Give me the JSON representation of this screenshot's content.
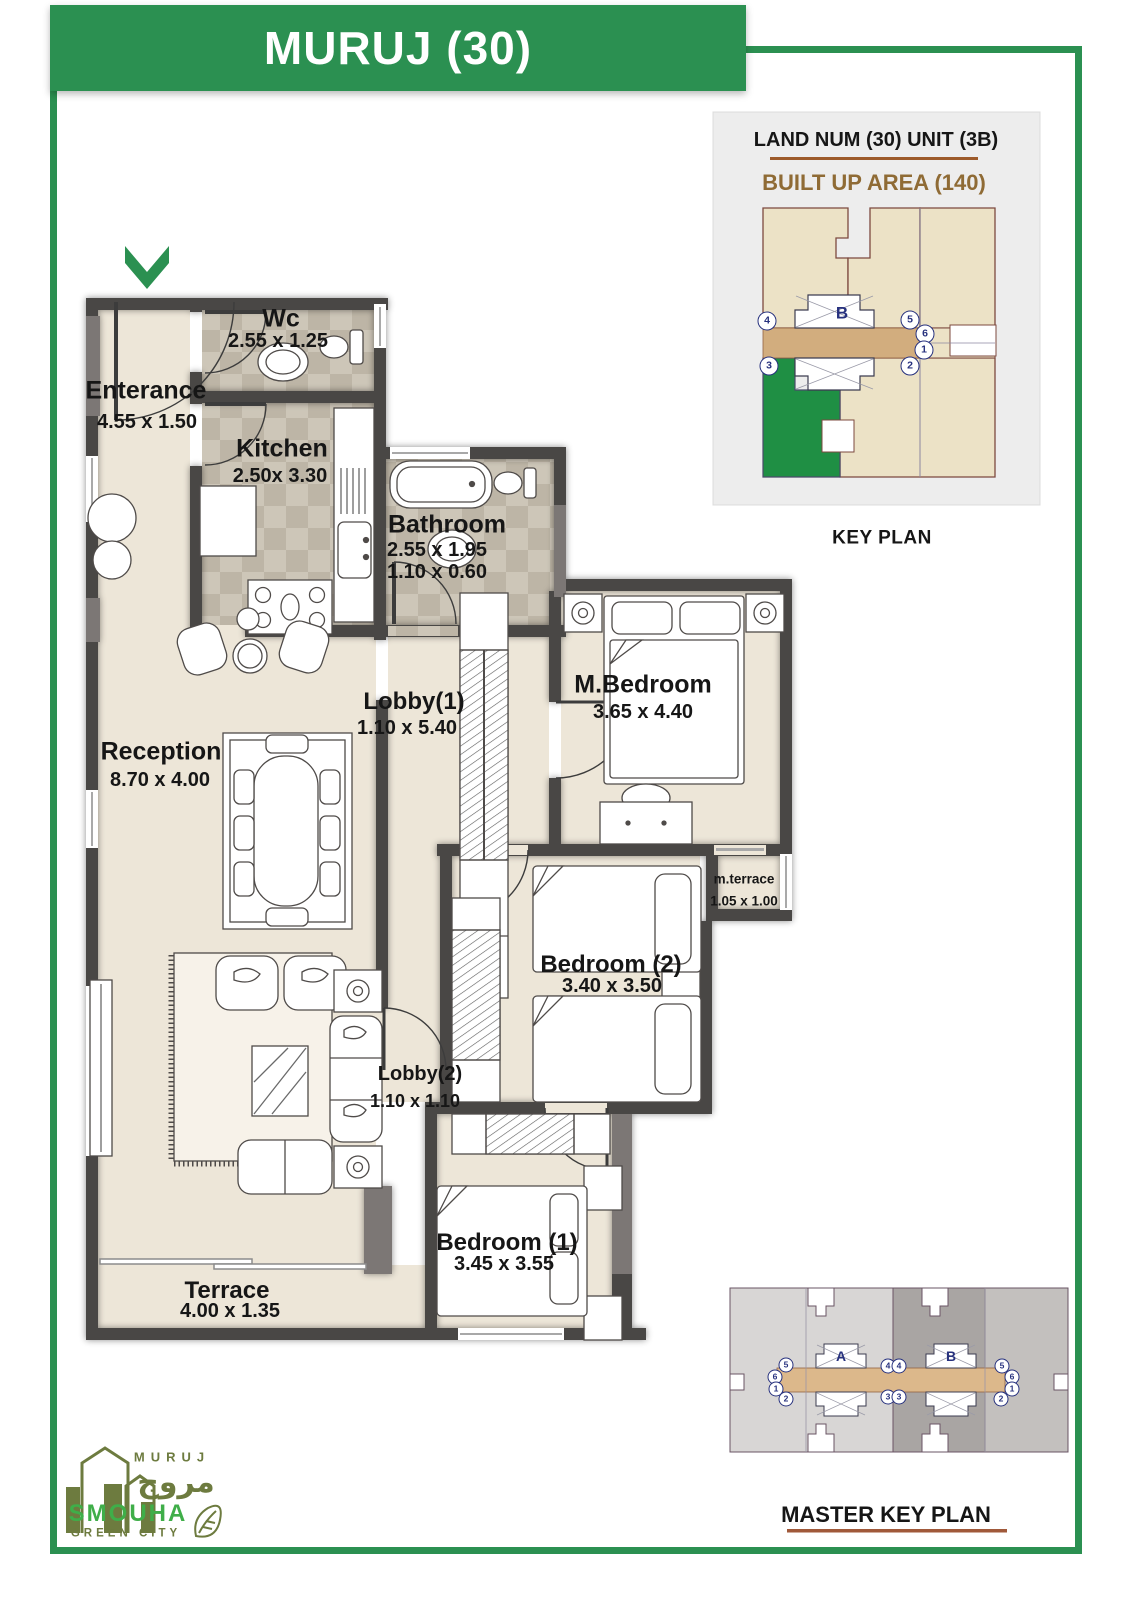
{
  "title": "MURUJ (30)",
  "key_plan": {
    "line1": "LAND NUM (30) UNIT (3B)",
    "line2": "BUILT UP AREA (140)",
    "caption": "KEY PLAN",
    "unit": "B",
    "markers": [
      "4",
      "5",
      "6",
      "1",
      "3",
      "2"
    ]
  },
  "master_key_plan": {
    "caption": "MASTER KEY PLAN",
    "block_a": "A",
    "block_b": "B",
    "markers": [
      "5",
      "6",
      "1",
      "2",
      "4",
      "4",
      "3",
      "3",
      "5",
      "6",
      "1",
      "2"
    ]
  },
  "rooms": [
    {
      "name": "Wc",
      "dims": "2.55 x 1.25"
    },
    {
      "name": "Enterance",
      "dims": "4.55 x 1.50"
    },
    {
      "name": "Kitchen",
      "dims": "2.50x 3.30"
    },
    {
      "name": "Bathroom",
      "dims": "2.55 x 1.95",
      "dims2": "1.10 x 0.60"
    },
    {
      "name": "Lobby(1)",
      "dims": "1.10 x 5.40"
    },
    {
      "name": "M.Bedroom",
      "dims": "3.65 x 4.40"
    },
    {
      "name": "Reception",
      "dims": "8.70 x 4.00"
    },
    {
      "name": "m.terrace",
      "dims": "1.05 x 1.00"
    },
    {
      "name": "Bedroom (2)",
      "dims": "3.40 x 3.50"
    },
    {
      "name": "Lobby(2)",
      "dims": "1.10 x 1.10"
    },
    {
      "name": "Bedroom (1)",
      "dims": "3.45 x 3.55"
    },
    {
      "name": "Terrace",
      "dims": "4.00 x 1.35"
    }
  ],
  "logo": {
    "brand": "MURUJ",
    "brand_arabic": "مروج",
    "name": "SMOUHA",
    "tagline": "GREEN CITY"
  },
  "colors": {
    "green": "#2b9051",
    "wall": "#4a4645",
    "floor": "#ede6d8",
    "tile": "#c9c2b4",
    "corridor_tan": "#d2ad7e",
    "key_beige": "#ece2c6",
    "navy": "#27317e",
    "brown": "#9c5a2a",
    "olive": "#6d7b3f",
    "logo_green": "#3fae49"
  }
}
